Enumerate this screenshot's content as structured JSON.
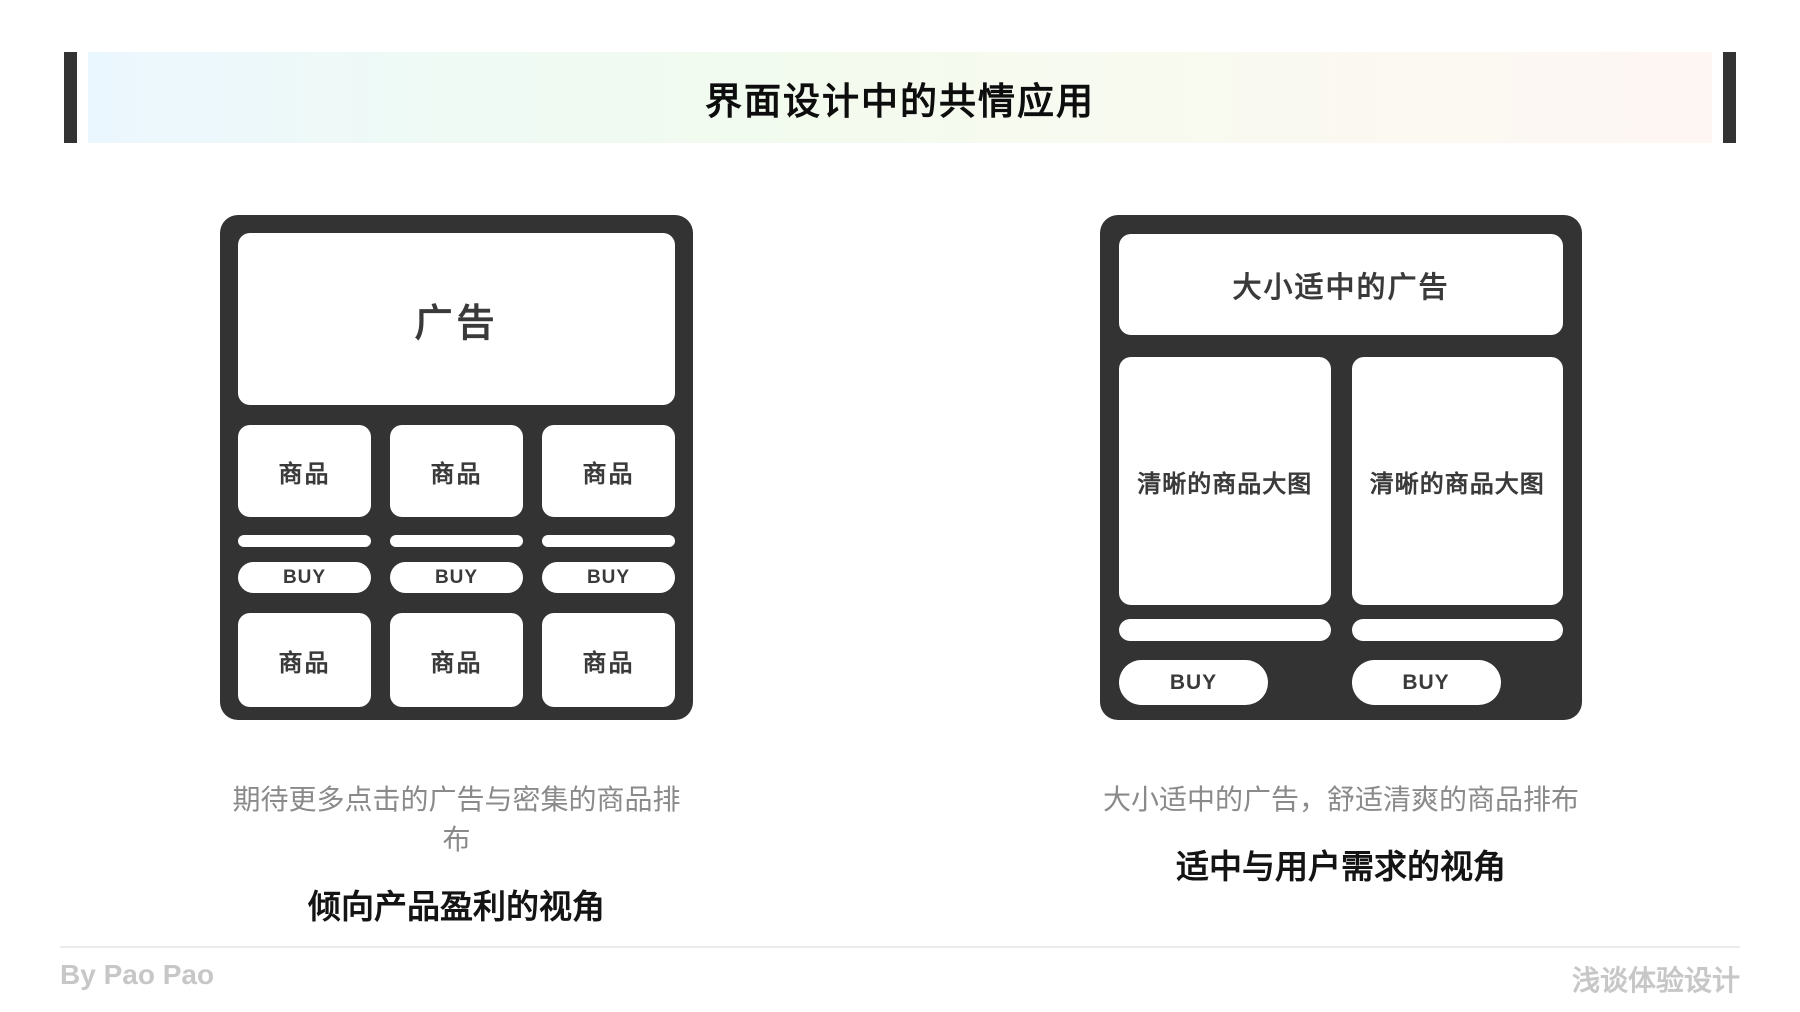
{
  "header": {
    "title": "界面设计中的共情应用"
  },
  "colors": {
    "mockup_dark": "#333333",
    "card_white": "#ffffff",
    "card_text": "#3a3a3a",
    "gradient_left": "#ebf7fe",
    "gradient_mid": "#f3fbee",
    "gradient_right": "#fdf6f3",
    "caption_gray": "#8a8a8a",
    "viewpoint_black": "#141414",
    "footer_gray": "#c7c7c7"
  },
  "left_mockup": {
    "ad_label": "广告",
    "product_label": "商品",
    "buy_label": "BUY",
    "caption": "期待更多点击的广告与密集的商品排布",
    "viewpoint": "倾向产品盈利的视角"
  },
  "right_mockup": {
    "ad_label": "大小适中的广告",
    "product_label": "清晰的商品大图",
    "buy_label": "BUY",
    "caption": "大小适中的广告，舒适清爽的商品排布",
    "viewpoint": "适中与用户需求的视角"
  },
  "footer": {
    "author": "By Pao Pao",
    "brand": "浅谈体验设计"
  }
}
